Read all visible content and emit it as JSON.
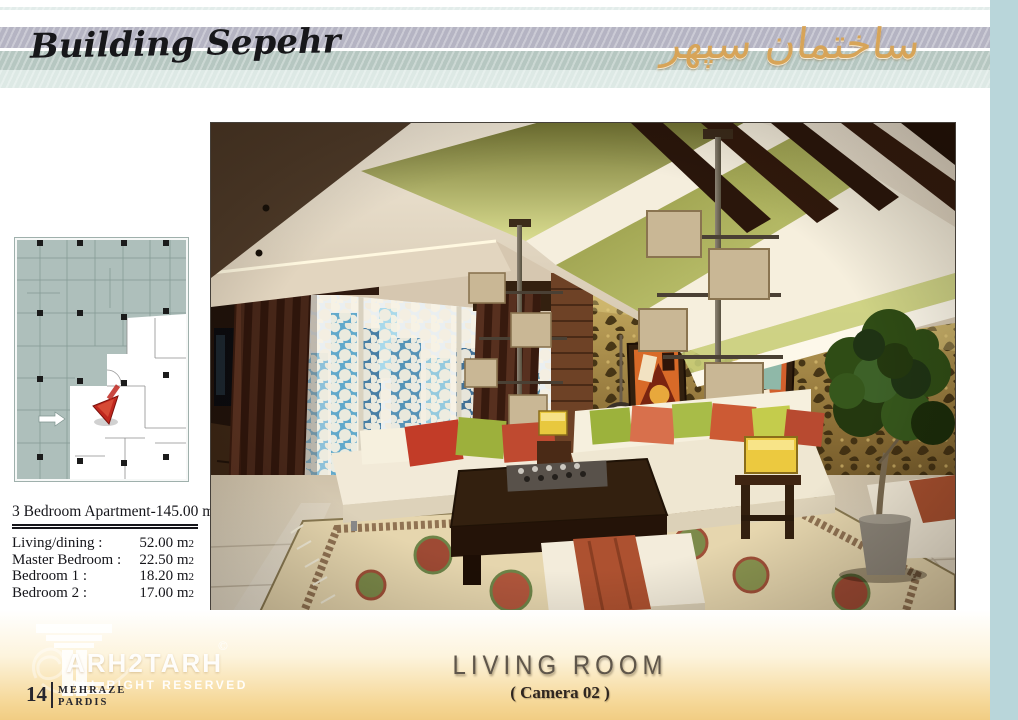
{
  "header": {
    "title_en": "Building Sepehr",
    "title_fa": "ساختمان سپهر"
  },
  "apartment": {
    "title": "3 Bedroom Apartment-145.00 m",
    "title_sub": "2",
    "rows": [
      {
        "label": "Living/dining :",
        "value": "52.00 m",
        "sub": "2"
      },
      {
        "label": "Master Bedroom :",
        "value": "22.50 m",
        "sub": "2"
      },
      {
        "label": "Bedroom 1 :",
        "value": "18.20 m",
        "sub": "2"
      },
      {
        "label": "Bedroom 2 :",
        "value": "17.00 m",
        "sub": "2"
      }
    ]
  },
  "footer": {
    "logo_text": "ARH2TARH",
    "copyright": "©",
    "rights": "ALL RIGHT RESERVED",
    "page_number": "14",
    "brand_line1": "MEHRAZE",
    "brand_line2": "PARDIS",
    "caption_title": "LIVING ROOM",
    "caption_subtitle": "( Camera 02 )"
  },
  "colors": {
    "edge_bar": "#b9d6da",
    "stripe_lavender": "#b5b4c3",
    "stripe_sage": "#b6c7c1",
    "stripe_mint": "#dde9e5",
    "farsi_gold": "#d7a458",
    "footer_gold": "#f1cd83",
    "plan_overlay_teal": "#aebfbb",
    "plan_marker_red": "#c0271e"
  }
}
